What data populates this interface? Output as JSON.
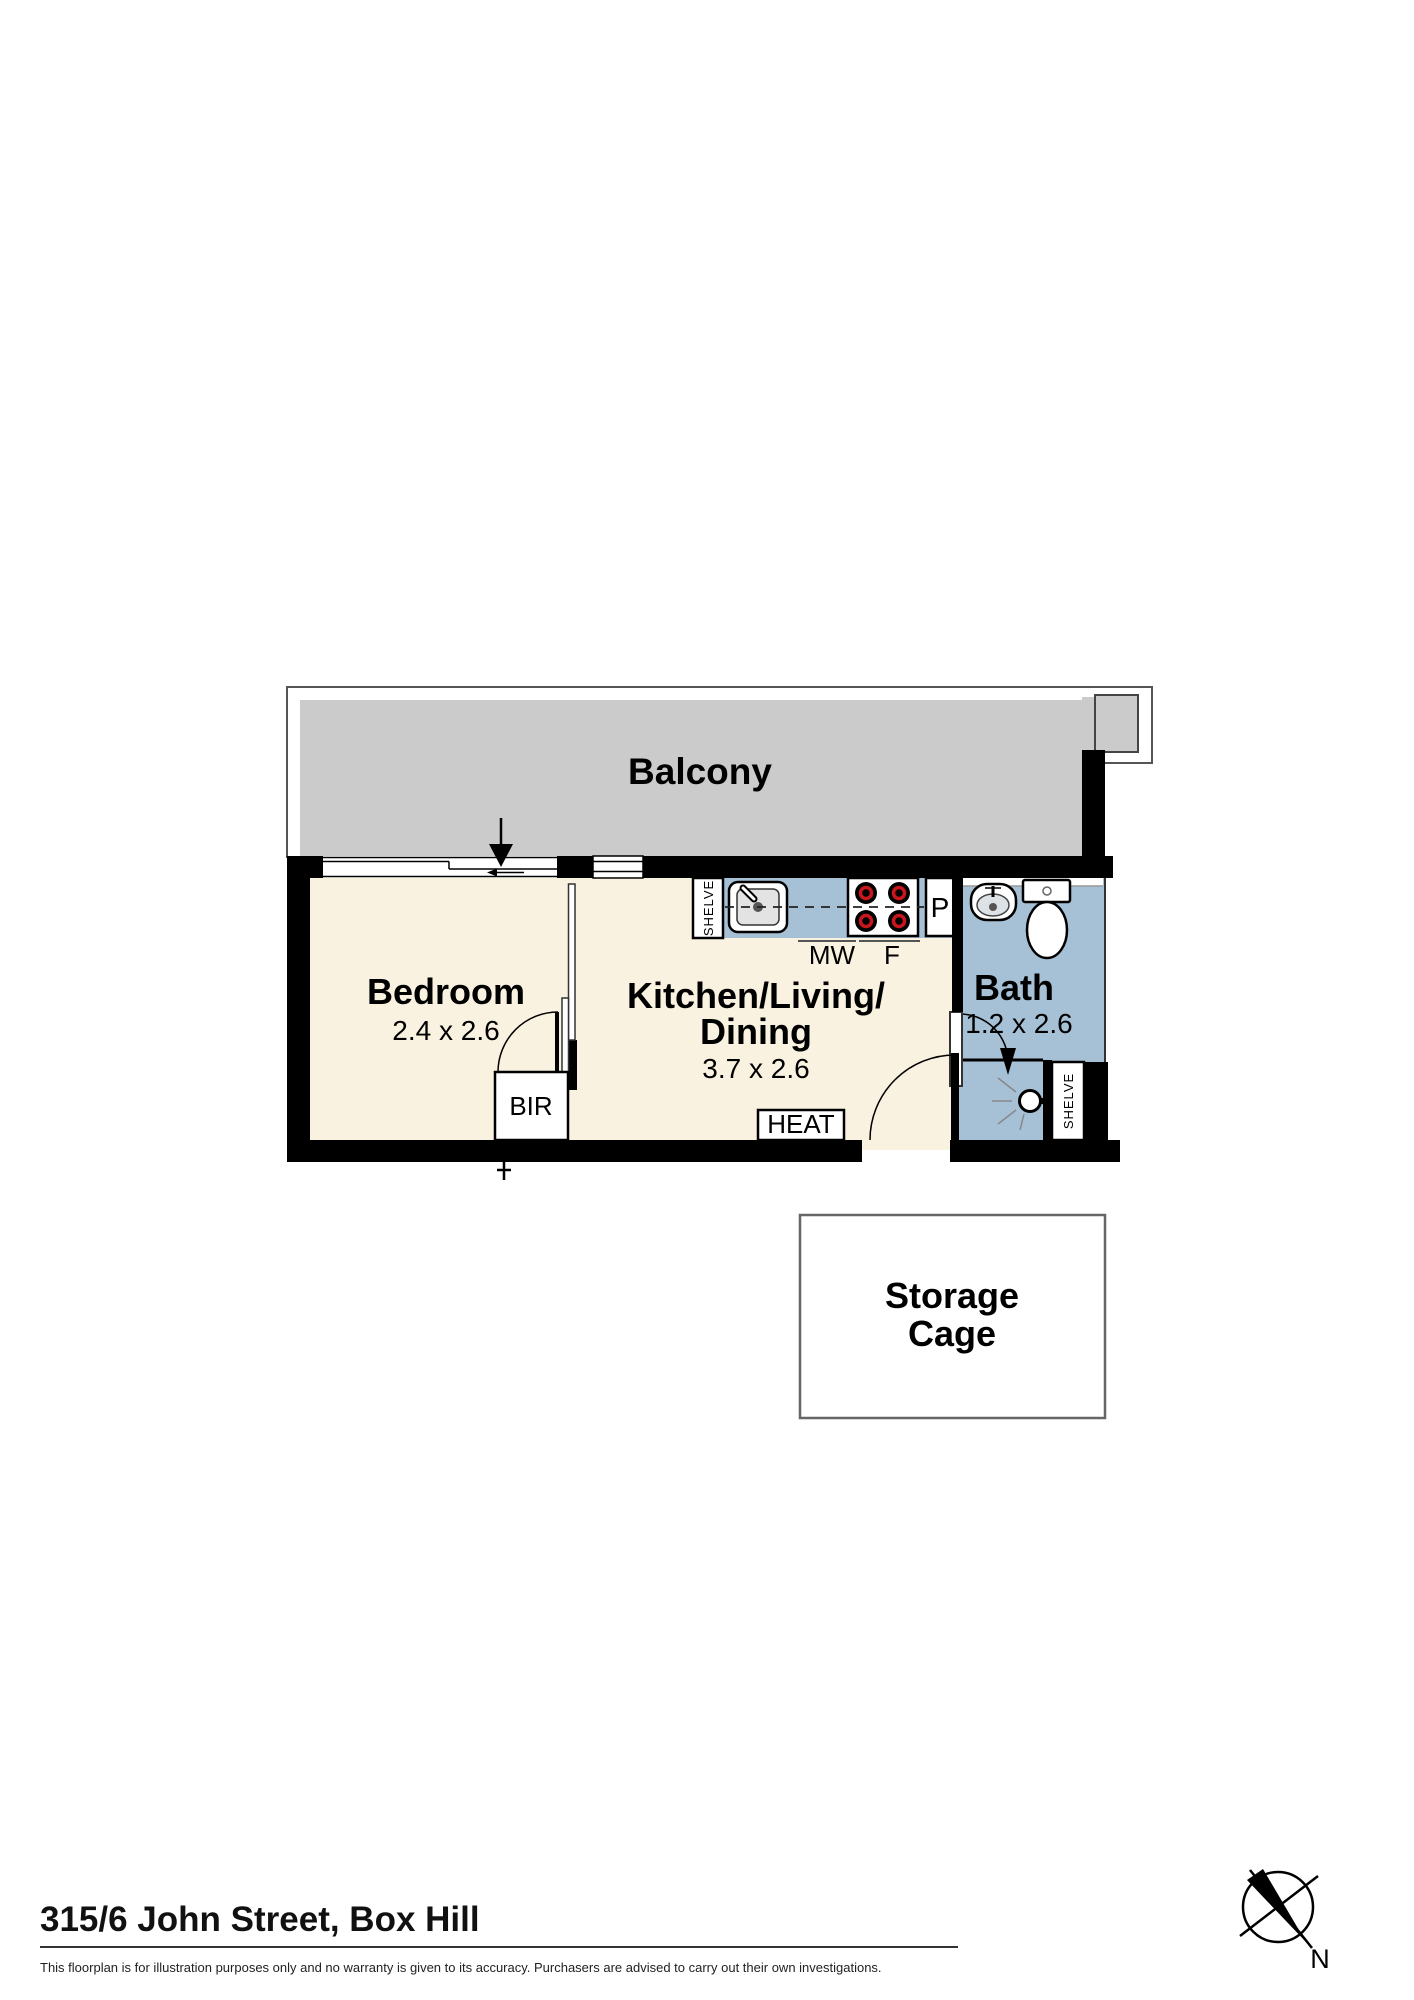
{
  "floorplan": {
    "balcony": {
      "label": "Balcony",
      "floor_color": "#cbcbcb"
    },
    "bedroom": {
      "label": "Bedroom",
      "dimensions": "2.4 x 2.6",
      "floor_color": "#faf2e0"
    },
    "kitchen_living_dining": {
      "label_line1": "Kitchen/Living/",
      "label_line2": "Dining",
      "dimensions": "3.7 x 2.6",
      "floor_color": "#faf2e0"
    },
    "bath": {
      "label": "Bath",
      "dimensions": "1.2 x 2.6",
      "floor_color": "#a6c0d5"
    },
    "storage_cage": {
      "label_line1": "Storage",
      "label_line2": "Cage"
    },
    "fixtures": {
      "kitchen_shelf_label": "SHELVE",
      "bath_shelf_label": "SHELVE",
      "microwave_label": "MW",
      "fridge_label": "F",
      "pantry_label": "P",
      "built_in_robe_label": "BIR",
      "heater_label": "HEAT"
    },
    "wall_color": "#000000",
    "counter_color": "#a6c0d5",
    "stove_burner_color": "#c8161d",
    "compass": {
      "north_label": "N"
    }
  },
  "footer": {
    "address": "315/6 John Street, Box Hill",
    "disclaimer": "This floorplan is for illustration purposes only and no warranty is given to its accuracy. Purchasers are advised to carry out their own investigations."
  }
}
